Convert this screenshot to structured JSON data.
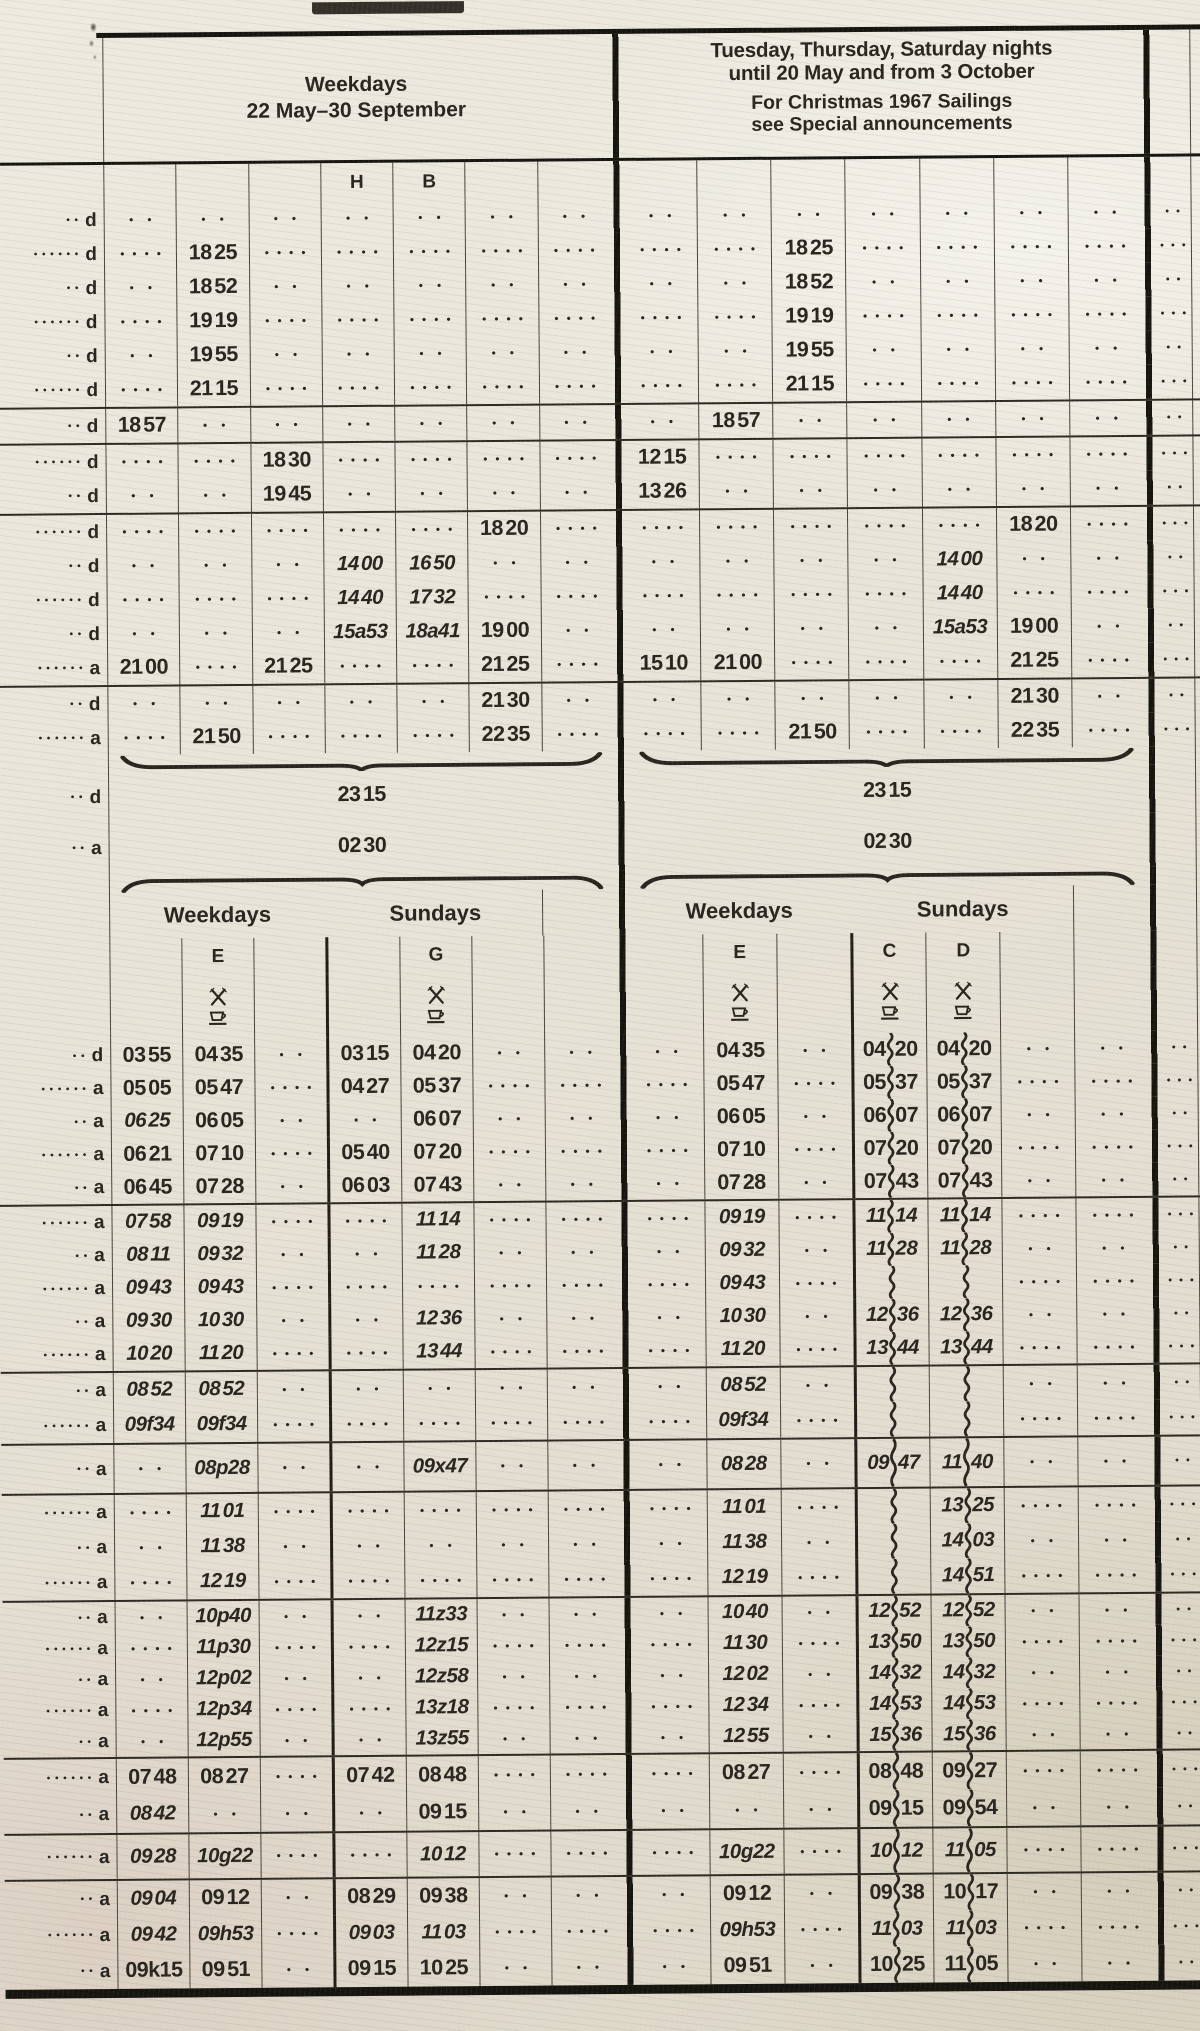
{
  "legend_internal": {
    "cell_encoding": "empty string = leader dots, * prefix = italic time, ~ = wavy vertical line (between hh and mm, or alone)",
    "dot_parity": "p is 2 or 4 = number of leader dots printed in empty cells of that row"
  },
  "header": {
    "left_title_line1": "Weekdays",
    "left_title_line2": "22 May–30 September",
    "right_title_line1": "Tuesday, Thursday, Saturday nights",
    "right_title_line2": "until 20 May and from 3 October",
    "right_note_line1": "For Christmas 1967 Sailings",
    "right_note_line2": "see Special announcements"
  },
  "column_letters_top": {
    "left": [
      {
        "col": 4,
        "letter": "H"
      },
      {
        "col": 5,
        "letter": "B"
      }
    ],
    "right": []
  },
  "markers": {
    "depart": "d",
    "arrive": "a"
  },
  "brace_block": {
    "depart_marker": "d",
    "depart_time": "23 15",
    "arrive_marker": "a",
    "arrive_time": "02 30"
  },
  "subheader": {
    "weekdays_label": "Weekdays",
    "sundays_label": "Sundays",
    "left_letters": [
      {
        "col": 2,
        "letter": "E"
      },
      {
        "col": 5,
        "letter": "G"
      }
    ],
    "right_letters": [
      {
        "col": 2,
        "letter": "E"
      },
      {
        "col": 4,
        "letter": "C"
      },
      {
        "col": 5,
        "letter": "D"
      }
    ],
    "left_symbol_cols": [
      2,
      5
    ],
    "right_symbol_cols": [
      2,
      4,
      5
    ],
    "symbols": [
      "crossed-cutlery",
      "cup"
    ]
  },
  "sections_upper": [
    {
      "id": "s1",
      "rule": false,
      "rows": [
        {
          "m": "d",
          "p": 2,
          "L": [
            "",
            "",
            "",
            "",
            "",
            "",
            ""
          ],
          "R": [
            "",
            "",
            "",
            "",
            "",
            "",
            ""
          ]
        },
        {
          "m": "d",
          "p": 4,
          "L": [
            "",
            "18 25",
            "",
            "",
            "",
            "",
            ""
          ],
          "R": [
            "",
            "",
            "18 25",
            "",
            "",
            "",
            ""
          ]
        },
        {
          "m": "d",
          "p": 2,
          "L": [
            "",
            "18 52",
            "",
            "",
            "",
            "",
            ""
          ],
          "R": [
            "",
            "",
            "18 52",
            "",
            "",
            "",
            ""
          ]
        },
        {
          "m": "d",
          "p": 4,
          "L": [
            "",
            "19 19",
            "",
            "",
            "",
            "",
            ""
          ],
          "R": [
            "",
            "",
            "19 19",
            "",
            "",
            "",
            ""
          ]
        },
        {
          "m": "d",
          "p": 2,
          "L": [
            "",
            "19 55",
            "",
            "",
            "",
            "",
            ""
          ],
          "R": [
            "",
            "",
            "19 55",
            "",
            "",
            "",
            ""
          ]
        },
        {
          "m": "d",
          "p": 4,
          "L": [
            "",
            "21 15",
            "",
            "",
            "",
            "",
            ""
          ],
          "R": [
            "",
            "",
            "21 15",
            "",
            "",
            "",
            ""
          ]
        }
      ]
    },
    {
      "id": "s2",
      "rule": true,
      "rows": [
        {
          "m": "d",
          "p": 2,
          "L": [
            "18 57",
            "",
            "",
            "",
            "",
            "",
            ""
          ],
          "R": [
            "",
            "18 57",
            "",
            "",
            "",
            "",
            ""
          ]
        }
      ]
    },
    {
      "id": "s3",
      "rule": true,
      "rows": [
        {
          "m": "d",
          "p": 4,
          "L": [
            "",
            "",
            "18 30",
            "",
            "",
            "",
            ""
          ],
          "R": [
            "12 15",
            "",
            "",
            "",
            "",
            "",
            ""
          ]
        },
        {
          "m": "d",
          "p": 2,
          "L": [
            "",
            "",
            "19 45",
            "",
            "",
            "",
            ""
          ],
          "R": [
            "13 26",
            "",
            "",
            "",
            "",
            "",
            ""
          ]
        }
      ]
    },
    {
      "id": "s4",
      "rule": true,
      "rows": [
        {
          "m": "d",
          "p": 4,
          "L": [
            "",
            "",
            "",
            "",
            "",
            "18 20",
            ""
          ],
          "R": [
            "",
            "",
            "",
            "",
            "",
            "18 20",
            ""
          ]
        },
        {
          "m": "d",
          "p": 2,
          "L": [
            "",
            "",
            "",
            "*14 00",
            "*16 50",
            "",
            ""
          ],
          "R": [
            "",
            "",
            "",
            "",
            "*14 00",
            "",
            ""
          ]
        },
        {
          "m": "d",
          "p": 4,
          "L": [
            "",
            "",
            "",
            "*14 40",
            "*17 32",
            "",
            ""
          ],
          "R": [
            "",
            "",
            "",
            "",
            "*14 40",
            "",
            ""
          ]
        },
        {
          "m": "d",
          "p": 2,
          "L": [
            "",
            "",
            "",
            "*15a53",
            "*18a41",
            "19 00",
            ""
          ],
          "R": [
            "",
            "",
            "",
            "",
            "*15a53",
            "19 00",
            ""
          ]
        },
        {
          "m": "a",
          "p": 4,
          "L": [
            "21 00",
            "",
            "21 25",
            "",
            "",
            "21 25",
            ""
          ],
          "R": [
            "15 10",
            "21 00",
            "",
            "",
            "",
            "21 25",
            ""
          ]
        }
      ]
    },
    {
      "id": "s5",
      "rule": true,
      "rows": [
        {
          "m": "d",
          "p": 2,
          "L": [
            "",
            "",
            "",
            "",
            "",
            "21 30",
            ""
          ],
          "R": [
            "",
            "",
            "",
            "",
            "",
            "21 30",
            ""
          ]
        },
        {
          "m": "a",
          "p": 4,
          "L": [
            "",
            "21 50",
            "",
            "",
            "",
            "22 35",
            ""
          ],
          "R": [
            "",
            "",
            "21 50",
            "",
            "",
            "22 35",
            ""
          ]
        }
      ]
    }
  ],
  "sections_lower": [
    {
      "id": "s6",
      "rule": false,
      "rows": [
        {
          "m": "d",
          "p": 2,
          "L": [
            "03 55",
            "04 35",
            "",
            "03 15",
            "04 20",
            "",
            ""
          ],
          "R": [
            "",
            "04 35",
            "",
            "04~20",
            "04~20",
            "",
            ""
          ]
        },
        {
          "m": "a",
          "p": 4,
          "L": [
            "05 05",
            "05 47",
            "",
            "04 27",
            "05 37",
            "",
            ""
          ],
          "R": [
            "",
            "05 47",
            "",
            "05~37",
            "05~37",
            "",
            ""
          ]
        },
        {
          "m": "a",
          "p": 2,
          "L": [
            "*06 25",
            "06 05",
            "",
            "",
            "06 07",
            "",
            ""
          ],
          "R": [
            "",
            "06 05",
            "",
            "06~07",
            "06~07",
            "",
            ""
          ]
        },
        {
          "m": "a",
          "p": 4,
          "L": [
            "06 21",
            "07 10",
            "",
            "05 40",
            "07 20",
            "",
            ""
          ],
          "R": [
            "",
            "07 10",
            "",
            "07~20",
            "07~20",
            "",
            ""
          ]
        },
        {
          "m": "a",
          "p": 2,
          "L": [
            "06 45",
            "07 28",
            "",
            "06 03",
            "07 43",
            "",
            ""
          ],
          "R": [
            "",
            "07 28",
            "",
            "07~43",
            "07~43",
            "",
            ""
          ]
        }
      ]
    },
    {
      "id": "s7",
      "rule": true,
      "rows": [
        {
          "m": "a",
          "p": 4,
          "L": [
            "*07 58",
            "*09 19",
            "",
            "",
            "*11 14",
            "",
            ""
          ],
          "R": [
            "",
            "*09 19",
            "",
            "*11~14",
            "*11~14",
            "",
            ""
          ]
        },
        {
          "m": "a",
          "p": 2,
          "L": [
            "*08 11",
            "*09 32",
            "",
            "",
            "*11 28",
            "",
            ""
          ],
          "R": [
            "",
            "*09 32",
            "",
            "*11~28",
            "*11~28",
            "",
            ""
          ]
        },
        {
          "m": "a",
          "p": 4,
          "L": [
            "*09 43",
            "*09 43",
            "",
            "",
            "",
            "",
            ""
          ],
          "R": [
            "",
            "*09 43",
            "",
            "~",
            "~",
            "",
            ""
          ]
        },
        {
          "m": "a",
          "p": 2,
          "L": [
            "*09 30",
            "*10 30",
            "",
            "",
            "*12 36",
            "",
            ""
          ],
          "R": [
            "",
            "*10 30",
            "",
            "*12~36",
            "*12~36",
            "",
            ""
          ]
        },
        {
          "m": "a",
          "p": 4,
          "L": [
            "*10 20",
            "*11 20",
            "",
            "",
            "*13 44",
            "",
            ""
          ],
          "R": [
            "",
            "*11 20",
            "",
            "*13~44",
            "*13~44",
            "",
            ""
          ]
        }
      ]
    },
    {
      "id": "s8",
      "rule": true,
      "rows": [
        {
          "m": "a",
          "p": 2,
          "L": [
            "*08 52",
            "*08 52",
            "",
            "",
            "",
            "",
            ""
          ],
          "R": [
            "",
            "*08 52",
            "",
            "~",
            "~",
            "",
            ""
          ]
        },
        {
          "m": "a",
          "p": 4,
          "L": [
            "*09f34",
            "*09f34",
            "",
            "",
            "",
            "",
            ""
          ],
          "R": [
            "",
            "*09f34",
            "",
            "~",
            "~",
            "",
            ""
          ]
        }
      ]
    },
    {
      "id": "s9",
      "rule": true,
      "rows": [
        {
          "m": "a",
          "p": 2,
          "L": [
            "",
            "*08p28",
            "",
            "",
            "*09x47",
            "",
            ""
          ],
          "R": [
            "",
            "*08 28",
            "",
            "*09~47",
            "*11~40",
            "",
            ""
          ]
        }
      ]
    },
    {
      "id": "s10",
      "rule": true,
      "rows": [
        {
          "m": "a",
          "p": 4,
          "L": [
            "",
            "*11 01",
            "",
            "",
            "",
            "",
            ""
          ],
          "R": [
            "",
            "*11 01",
            "",
            "~",
            "*13~25",
            "",
            ""
          ]
        },
        {
          "m": "a",
          "p": 2,
          "L": [
            "",
            "*11 38",
            "",
            "",
            "",
            "",
            ""
          ],
          "R": [
            "",
            "*11 38",
            "",
            "~",
            "*14~03",
            "",
            ""
          ]
        },
        {
          "m": "a",
          "p": 4,
          "L": [
            "",
            "*12 19",
            "",
            "",
            "",
            "",
            ""
          ],
          "R": [
            "",
            "*12 19",
            "",
            "~",
            "*14~51",
            "",
            ""
          ]
        }
      ]
    },
    {
      "id": "s11",
      "rule": true,
      "rows": [
        {
          "m": "a",
          "p": 2,
          "L": [
            "",
            "*10p40",
            "",
            "",
            "*11z33",
            "",
            ""
          ],
          "R": [
            "",
            "*10 40",
            "",
            "*12~52",
            "*12~52",
            "",
            ""
          ]
        },
        {
          "m": "a",
          "p": 4,
          "L": [
            "",
            "*11p30",
            "",
            "",
            "*12z15",
            "",
            ""
          ],
          "R": [
            "",
            "*11 30",
            "",
            "*13~50",
            "*13~50",
            "",
            ""
          ]
        },
        {
          "m": "a",
          "p": 2,
          "L": [
            "",
            "*12p02",
            "",
            "",
            "*12z58",
            "",
            ""
          ],
          "R": [
            "",
            "*12 02",
            "",
            "*14~32",
            "*14~32",
            "",
            ""
          ]
        },
        {
          "m": "a",
          "p": 4,
          "L": [
            "",
            "*12p34",
            "",
            "",
            "*13z18",
            "",
            ""
          ],
          "R": [
            "",
            "*12 34",
            "",
            "*14~53",
            "*14~53",
            "",
            ""
          ]
        },
        {
          "m": "a",
          "p": 2,
          "L": [
            "",
            "*12p55",
            "",
            "",
            "*13z55",
            "",
            ""
          ],
          "R": [
            "",
            "*12 55",
            "",
            "*15~36",
            "*15~36",
            "",
            ""
          ]
        }
      ]
    },
    {
      "id": "s12",
      "rule": true,
      "rows": [
        {
          "m": "a",
          "p": 4,
          "L": [
            "07 48",
            "08 27",
            "",
            "07 42",
            "08 48",
            "",
            ""
          ],
          "R": [
            "",
            "08 27",
            "",
            "08~48",
            "09~27",
            "",
            ""
          ]
        },
        {
          "m": "a",
          "p": 2,
          "L": [
            "*08 42",
            "",
            "",
            "",
            "09 15",
            "",
            ""
          ],
          "R": [
            "",
            "",
            "",
            "09~15",
            "09~54",
            "",
            ""
          ]
        }
      ]
    },
    {
      "id": "s13",
      "rule": true,
      "rows": [
        {
          "m": "a",
          "p": 4,
          "L": [
            "*09 28",
            "*10g22",
            "",
            "",
            "*10 12",
            "",
            ""
          ],
          "R": [
            "",
            "*10g22",
            "",
            "*10~12",
            "*11~05",
            "",
            ""
          ]
        }
      ]
    },
    {
      "id": "s14",
      "rule": true,
      "rows": [
        {
          "m": "a",
          "p": 2,
          "L": [
            "*09 04",
            "09 12",
            "",
            "08 29",
            "09 38",
            "",
            ""
          ],
          "R": [
            "",
            "09 12",
            "",
            "09~38",
            "10~17",
            "",
            ""
          ]
        },
        {
          "m": "a",
          "p": 4,
          "L": [
            "*09 42",
            "*09h53",
            "",
            "*09 03",
            "*11 03",
            "",
            ""
          ],
          "R": [
            "",
            "*09h53",
            "",
            "*11~03",
            "*11~03",
            "",
            ""
          ]
        },
        {
          "m": "a",
          "p": 2,
          "L": [
            "09k15",
            "09 51",
            "",
            "09 15",
            "10 25",
            "",
            ""
          ],
          "R": [
            "",
            "09 51",
            "",
            "10~25",
            "11~05",
            "",
            ""
          ]
        }
      ]
    }
  ]
}
